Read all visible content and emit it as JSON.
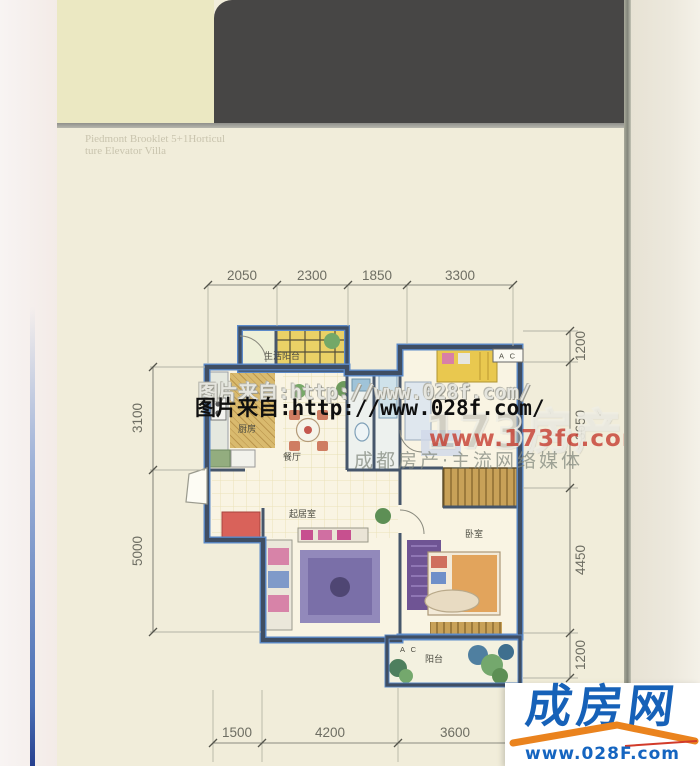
{
  "header": {
    "unit_code": "C4",
    "unit_type": "2房2厅",
    "area_label": "建筑面积:",
    "area_value": "84.90~85.81m",
    "area_unit_sup": "2",
    "english_line1": "Piedmont Brooklet 5+1Horticul",
    "english_line2": "ture Elevator Villa"
  },
  "brand": {
    "seal_text": "晋层",
    "calligraphy": "間水山",
    "subtitle": "【山麓·清涧·5+1中式电梯艺墅】"
  },
  "floorplan": {
    "rooms": {
      "living_balcony": "生活阳台",
      "kitchen": "厨房",
      "dining": "餐厅",
      "living": "起居室",
      "bedroom": "卧室",
      "balcony": "阳台"
    },
    "ac_label": "A C",
    "dims": {
      "top": [
        "2050",
        "2300",
        "1850",
        "3300"
      ],
      "right": [
        "1200",
        "3650",
        "4450",
        "1200"
      ],
      "left": [
        "3100",
        "5000"
      ],
      "bottom": [
        "1500",
        "4200",
        "3600"
      ]
    }
  },
  "watermarks": {
    "photo_source": "图片来自:http://www.028f.com/",
    "site_name": "173房产网",
    "site_url": "www.173fc.com",
    "site_tagline": "成都房产·主流网络媒体"
  },
  "footer_logo": {
    "name": "成房网",
    "url": "www.028F.com"
  },
  "colors": {
    "panel_cream": "#ebe8c2",
    "band_charcoal": "#474645",
    "wall_slate": "#3f4e63",
    "wall_blue_accent": "#5b8ac9",
    "logo_blue": "#1661b8",
    "swoosh_orange": "#ea831e",
    "watermark_red": "#c4372a",
    "page_cream": "#f1edda"
  }
}
